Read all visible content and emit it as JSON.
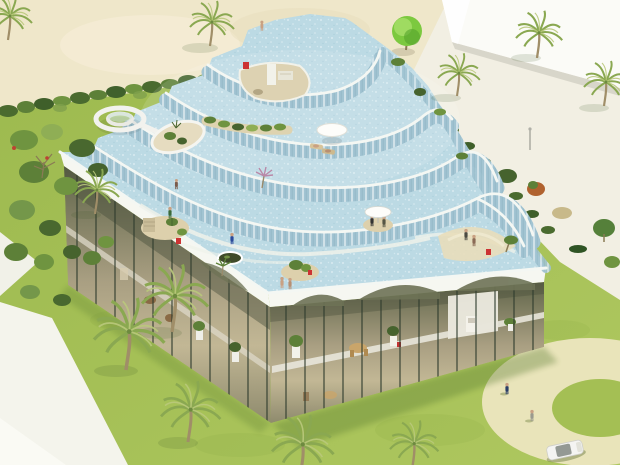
{
  "canvas": {
    "width": 620,
    "height": 465
  },
  "scene": {
    "type": "3d-architectural-rendering",
    "subject": "Terraced building with cascading rooftop swimming pools and waterfalls",
    "setting": "Beachfront lot: sand beach upper-left, neighboring white wall upper-right, lawns, hedges, palm trees, circular driveway lower-right",
    "terrace_levels": 5,
    "rooftop_features": [
      "spiral water slide",
      "sunken oval garden courtyard",
      "sunken stair courtyard",
      "rooftop planter strip",
      "round pavilion with loungers",
      "pool umbrella island",
      "trampoline circle",
      "sand beach entries",
      "planted islands",
      "bathers and visitors"
    ],
    "site_features": [
      "two-story glass facade with dark mullions",
      "white fascia with arched glass openings",
      "hedge row along beach",
      "shrub cluster west side",
      "white pedestrian path",
      "circular ring driveway",
      "white boundary wall",
      "street lamp"
    ],
    "vehicles": [
      "white car"
    ],
    "people_count_approx": 14,
    "palm_trees_count": 11
  },
  "colors": {
    "lawn": "#a4bf54",
    "lawn_dark": "#8aa845",
    "sand": "#efe7ca",
    "pavement": "#f2efe3",
    "wall_white": "#fbfbf7",
    "water": "#bcdae4",
    "riser": "#a2c4d2",
    "rim_white": "#f4f7f3",
    "fascia": "#f6f7f1",
    "glass_dark": "#6e7356",
    "glass_warm": "#b5ae8e",
    "mullion": "#2f3a2c",
    "hedge": "#4a6b2f",
    "bush_green": "#6f9440",
    "bush_light": "#8fae55",
    "bush_red": "#b0622f",
    "bush_tan": "#c8b98a",
    "palm_frond": "#8aa851",
    "palm_frond_light": "#bac97c",
    "palm_trunk": "#a08e68",
    "tree_bright": "#7cc93f",
    "ring_path": "#e9e4ba",
    "path_white": "#f4f4ec",
    "figure_blue": "#2a3e66",
    "accent_red": "#cc3333",
    "skin": "#c9a183",
    "car_white": "#f4f4f2",
    "trampoline": "#3f4a2a",
    "island_sand": "#ddd0ac",
    "umbrella_white": "#fdfdfa"
  }
}
